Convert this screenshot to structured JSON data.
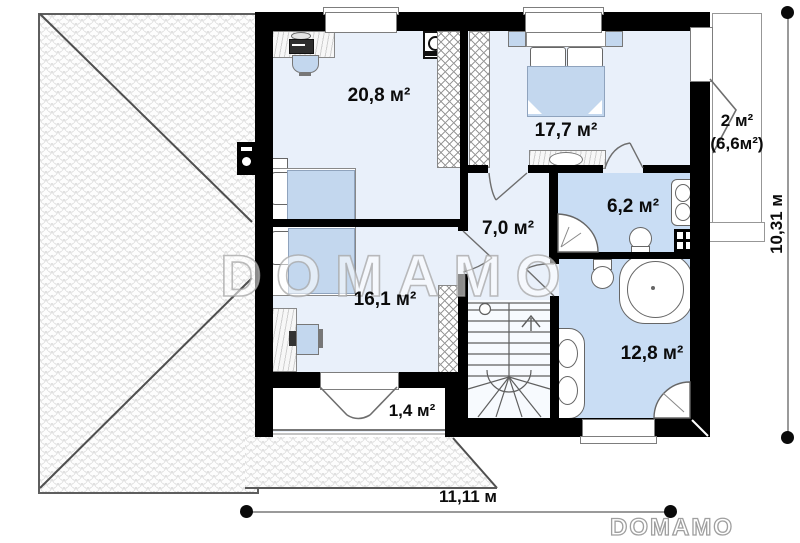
{
  "rooms": {
    "room_20_8": {
      "area": "20,8 м²"
    },
    "room_17_7": {
      "area": "17,7 м²"
    },
    "balcony_right": {
      "area": "2 м²",
      "area_total": "(6,6м²)"
    },
    "bath_6_2": {
      "area": "6,2 м²"
    },
    "hall_7_0": {
      "area": "7,0 м²"
    },
    "room_16_1": {
      "area": "16,1 м²"
    },
    "bath_12_8": {
      "area": "12,8 м²"
    },
    "balcony_1_4": {
      "area": "1,4 м²"
    }
  },
  "dimensions": {
    "width": "11,11 м",
    "height": "10,31 м"
  },
  "watermark": {
    "center_text": "DOMAMO",
    "corner_text": "DOMAMO"
  },
  "colors": {
    "wall": "#000000",
    "floor": "#e9f0fa",
    "bathroom_floor": "#c9ddf4",
    "furniture": "#c3d7ee",
    "roof_line": "#555555"
  }
}
